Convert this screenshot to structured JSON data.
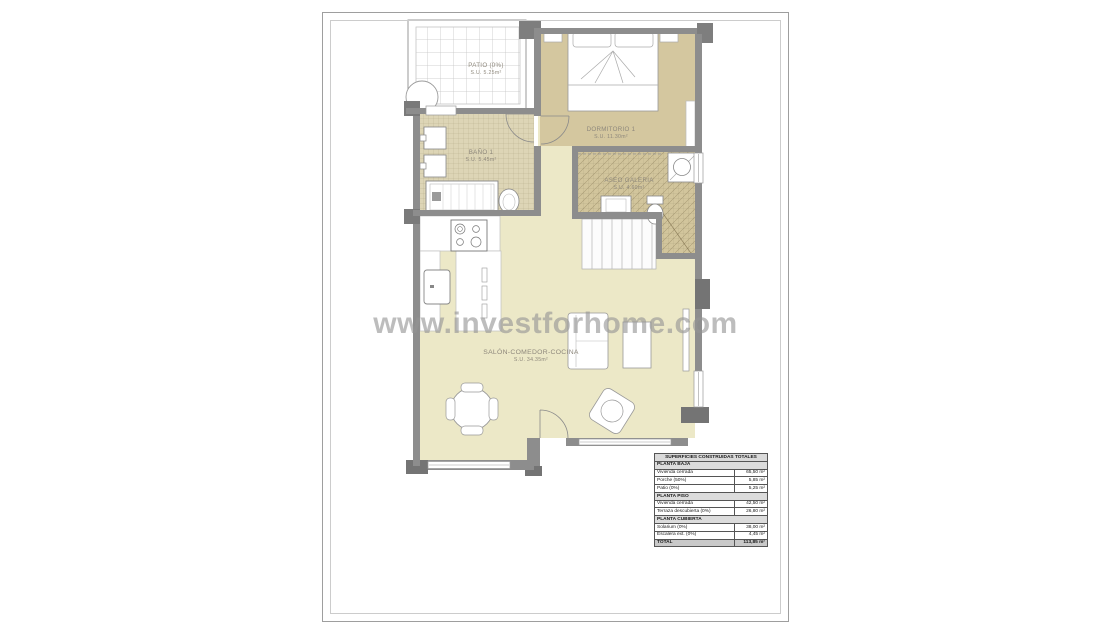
{
  "watermark": {
    "text": "www.investforhome.com"
  },
  "rooms": {
    "patio": {
      "name": "PATIO (0%)",
      "area": "S.U. 5.25m²"
    },
    "dormitorio": {
      "name": "DORMITORIO 1",
      "area": "S.U. 11.30m²"
    },
    "bano": {
      "name": "BAÑO 1",
      "area": "S.U. 5.45m²"
    },
    "aseo": {
      "name": "ASEO GALERIA",
      "area": "S.U. 4.60m²"
    },
    "salon": {
      "name": "SALÓN-COMEDOR-COCINA",
      "area": "S.U. 34.35m²"
    }
  },
  "surfaces_table": {
    "title": "SUPERFICIES CONSTRUIDAS TOTALES",
    "sections": [
      {
        "header": "PLANTA BAJA",
        "rows": [
          [
            "Vivienda cerrada",
            "65,50 m²"
          ],
          [
            "Porche (50%)",
            "5,85 m²"
          ],
          [
            "Patio (0%)",
            "5,25 m²"
          ]
        ]
      },
      {
        "header": "PLANTA PISO",
        "rows": [
          [
            "Vivienda cerrada",
            "42,50 m²"
          ],
          [
            "Terraza descubierta (0%)",
            "26,80 m²"
          ]
        ]
      },
      {
        "header": "PLANTA CUBIERTA",
        "rows": [
          [
            "Solarium (0%)",
            "38,00 m²"
          ],
          [
            "Escalera ext. (0%)",
            "4,45 m²"
          ]
        ]
      }
    ],
    "total_label": "TOTAL",
    "total_value": "113,85 m²"
  },
  "colors": {
    "wall": "#8d8d8d",
    "wall_dark": "#747474",
    "room_light": "#ece8c7",
    "room_tan": "#d4c79f",
    "tile_bath": "#ddd5b6",
    "label_text": "#8e887c",
    "watermark": "rgba(148,148,148,0.62)"
  }
}
